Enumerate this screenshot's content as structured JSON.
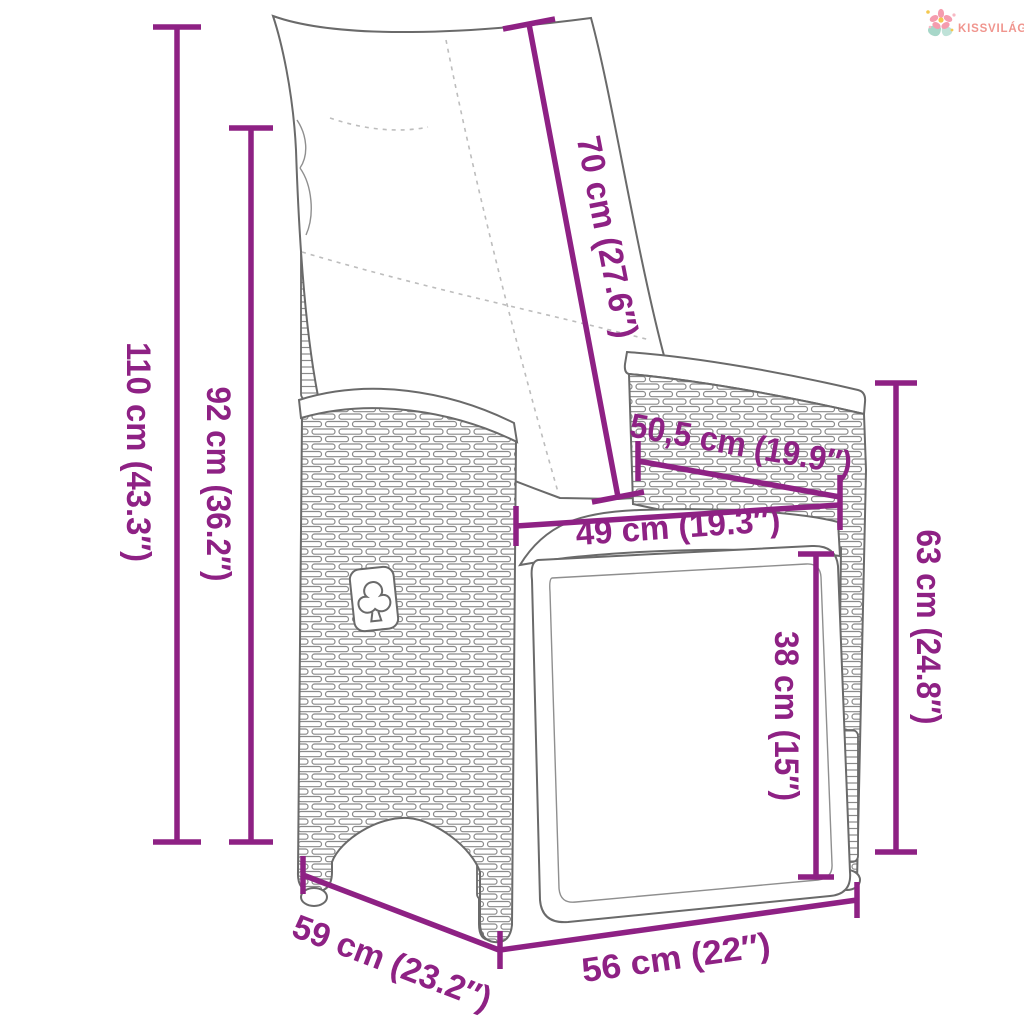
{
  "brand": {
    "name": "KISSVILÁG",
    "text_color": "#f0958e"
  },
  "diagram": {
    "product": "reclining-wicker-garden-chair-with-cushions",
    "accent_color": "#8e2184",
    "outline_color": "#6a6a6a",
    "dimensions": [
      {
        "id": "total-height",
        "label": "110 cm (43.3″)"
      },
      {
        "id": "back-height",
        "label": "92 cm (36.2″)"
      },
      {
        "id": "backrest-length",
        "label": "70 cm (27.6″)"
      },
      {
        "id": "back-width-diag",
        "label": "50,5 cm (19.9″)"
      },
      {
        "id": "seat-width",
        "label": "49 cm (19.3″)"
      },
      {
        "id": "seat-height",
        "label": "38 cm (15″)"
      },
      {
        "id": "side-height",
        "label": "63 cm (24.8″)"
      },
      {
        "id": "depth",
        "label": "59 cm (23.2″)"
      },
      {
        "id": "front-width",
        "label": "56 cm (22″)"
      }
    ]
  }
}
